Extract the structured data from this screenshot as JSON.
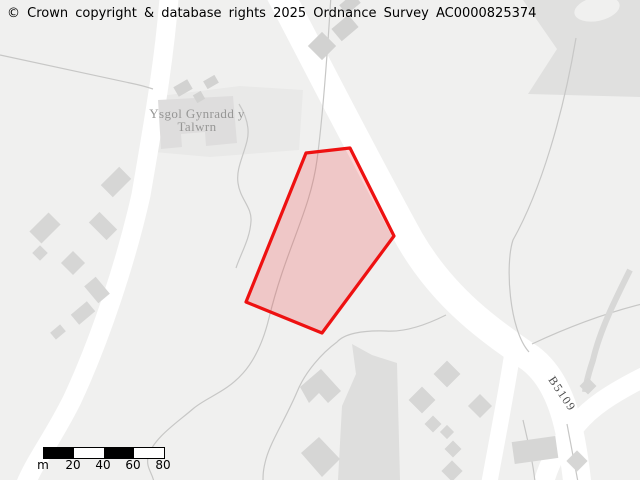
{
  "copyright_notice": "© Crown copyright & database rights 2025 Ordnance Survey AC0000825374",
  "map": {
    "place_label": {
      "line1": "Ysgol Gynradd y",
      "line2": "Talwrn"
    },
    "road_label": "B5109",
    "highlight_polygon": {
      "fill": "rgba(238,17,17,0.18)",
      "stroke": "#ee1111"
    },
    "colors": {
      "background": "#f0f0ef",
      "road": "#ffffff",
      "building": "#d6d6d5",
      "boundary_line": "#c7c7c6"
    }
  },
  "scale_bar": {
    "unit_label": "m",
    "tick_labels": [
      "20",
      "40",
      "60",
      "80"
    ]
  }
}
